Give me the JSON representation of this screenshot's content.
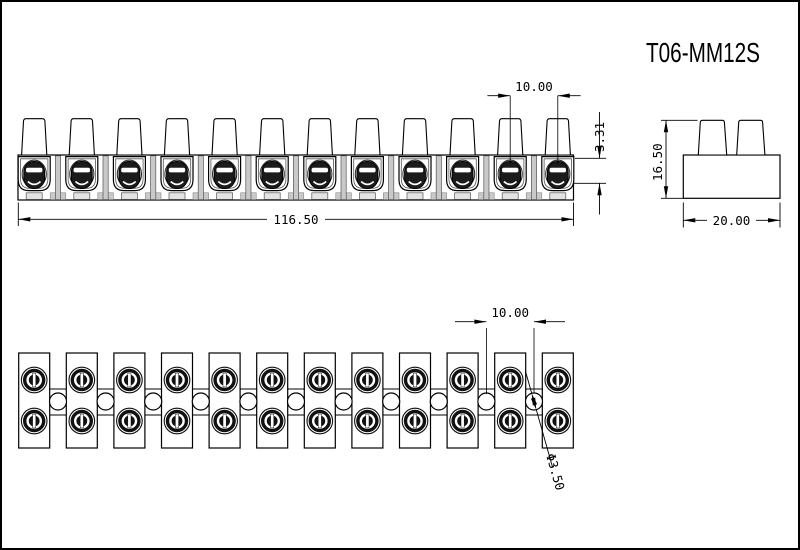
{
  "title": "T06-MM12S",
  "drawing": {
    "type": "terminal-block-strip",
    "positions": 12,
    "front": {
      "pitch": "10.00",
      "screw_offset": "3.31",
      "total_length": "116.50"
    },
    "end": {
      "height": "16.50",
      "depth": "20.00"
    },
    "plan": {
      "pitch": "10.00",
      "hole_diameter": "Φ3.50"
    }
  },
  "colors": {
    "line": "#000000",
    "screw_dark": "#1b1b1b",
    "shade": "#c9c9c9",
    "background": "#ffffff"
  }
}
